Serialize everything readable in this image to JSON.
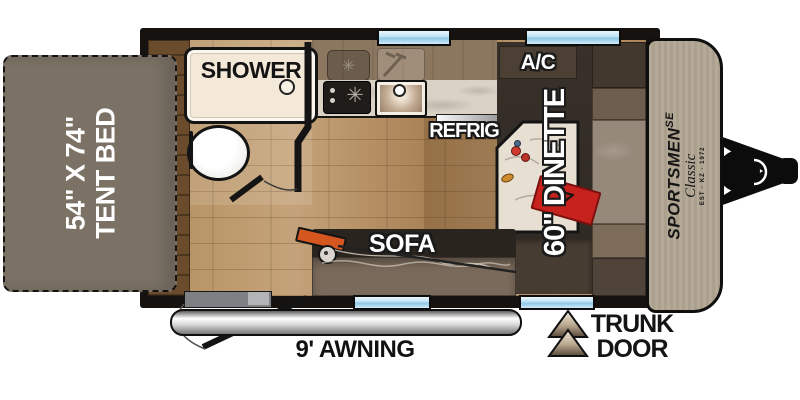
{
  "title": "Travel trailer floor plan",
  "exterior": {
    "tent_bed": {
      "size": "54\" X 74\"",
      "label": "TENT BED"
    },
    "awning": {
      "label": "9' AWNING"
    },
    "trunk_door": {
      "line1": "TRUNK",
      "line2": "DOOR"
    },
    "brand": {
      "name": "SPORTSMEN",
      "series": "SE",
      "model": "Classic",
      "est_line": "EST · KZ · 1972"
    }
  },
  "interior": {
    "shower": {
      "label": "SHOWER"
    },
    "refrigerator": {
      "label": "REFRIG"
    },
    "air_conditioner": {
      "label": "A/C"
    },
    "dinette": {
      "label": "60\" DINETTE"
    },
    "sofa": {
      "label": "SOFA"
    }
  },
  "icons": {
    "burner": "✳",
    "book_mark": "7"
  },
  "colors": {
    "tent_bed": "#7b7265",
    "shower_pan": "#f4e9d8",
    "wood_floor": "#b4905f",
    "counter_marble": "#d9d2c5",
    "bench_charcoal": "#332d27",
    "cabinet_brown": "#6d5d4c",
    "front_cap": "#b3a895",
    "window_blue": "#9fd2ec",
    "accent_red": "#c8221f",
    "rod_orange": "#d5571f",
    "awning_gray": "#c9c9c9"
  }
}
